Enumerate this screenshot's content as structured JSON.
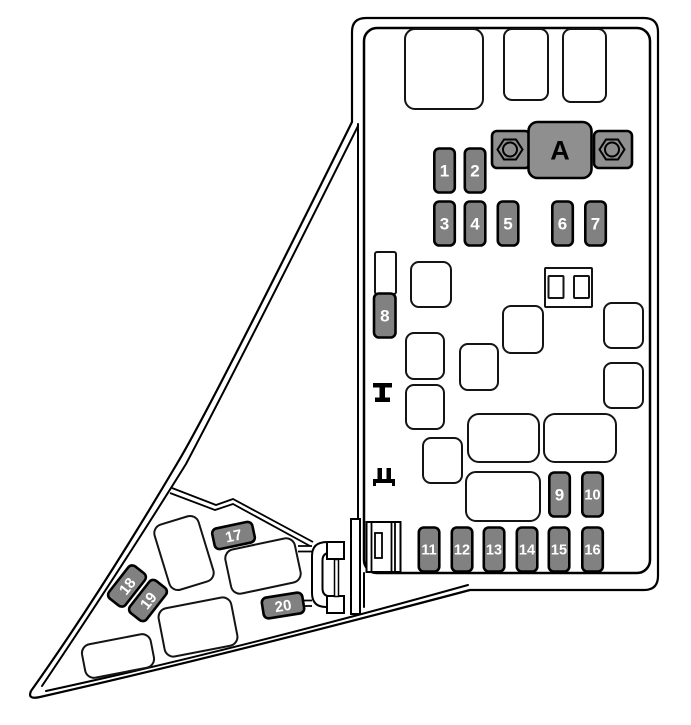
{
  "palette": {
    "outline": "#000000",
    "fuse_fill": "#818181",
    "link_fill": "#8f8f8f",
    "slot_fill": "#ffffff",
    "fuse_label_color": "#ffffff",
    "link_label_color": "#000000"
  },
  "fusible_link": {
    "label": "A"
  },
  "fuses": [
    {
      "label": "1"
    },
    {
      "label": "2"
    },
    {
      "label": "3"
    },
    {
      "label": "4"
    },
    {
      "label": "5"
    },
    {
      "label": "6"
    },
    {
      "label": "7"
    },
    {
      "label": "8"
    },
    {
      "label": "9"
    },
    {
      "label": "10"
    },
    {
      "label": "11"
    },
    {
      "label": "12"
    },
    {
      "label": "13"
    },
    {
      "label": "14"
    },
    {
      "label": "15"
    },
    {
      "label": "16"
    },
    {
      "label": "17"
    },
    {
      "label": "18"
    },
    {
      "label": "19"
    },
    {
      "label": "20"
    }
  ]
}
